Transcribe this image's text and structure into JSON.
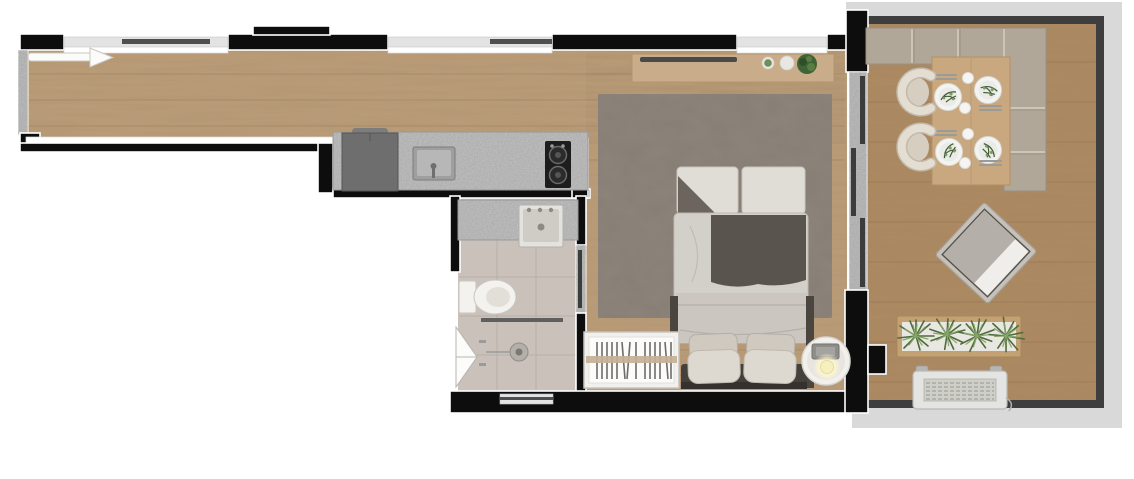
{
  "canvas": {
    "kind": "apartment-floor-plan-top-view",
    "width": 1134,
    "height": 479
  },
  "rooms": [
    {
      "name": "entry-kitchen-hall"
    },
    {
      "name": "bathroom"
    },
    {
      "name": "bedroom"
    },
    {
      "name": "balcony"
    }
  ],
  "furniture": [
    "entry-sliding-door",
    "kitchen-counter",
    "refrigerator",
    "kitchen-sink",
    "cooktop",
    "vanity-counter",
    "vanity-sink",
    "toilet",
    "shower-screen",
    "shower-bifold-door",
    "shower-drain",
    "bathroom-pocket-door",
    "sideboard",
    "decor-dishes",
    "potted-plant",
    "area-rug",
    "double-bed",
    "foot-cushions",
    "throw-blanket",
    "pillows",
    "slatted-bench",
    "bedside-table",
    "table-lamp",
    "balcony-sliding-door",
    "corner-bench-sofa",
    "dining-table",
    "dining-chairs",
    "place-settings",
    "lounge-chair",
    "planter-box",
    "ac-unit"
  ],
  "colors": {
    "wall": "#0d0d0d",
    "wallOutline": "#ffffff",
    "windowLight": "#e3e3e3",
    "windowDark": "#4f4f4f",
    "glassStrip": "#c2c2c2",
    "glassPanel": "#3c3c3c",
    "balconyWall": "#d9d9d9",
    "balconyWallDark": "#3e3e3e",
    "woodMain": "#bb9d79",
    "woodBalcony": "#ad8a62",
    "granite": "#c6c6c6",
    "tile": "#c9c1ba",
    "tileLine": "#b4aba4",
    "rug": "#8d847b",
    "appliance": "#6e6e6e",
    "cooktop": "#1d1d1d",
    "porcelain": "#f4f2ef",
    "sideboard": "#c9ac89",
    "sideboardGroove": "#4a4a4a",
    "duvet": "#d3cfc9",
    "blanket": "#59544e",
    "pillow": "#ddd8d0",
    "bedBase": "#44403c",
    "benchFrame": "#f1f0ee",
    "benchSlat": "#6f6c68",
    "benchRail": "#c3b196",
    "benchCushion": "#b1a798",
    "tableWood": "#c9a87f",
    "garnishDark": "#3f5a34",
    "garnishLight": "#7e9c63",
    "cutlery": "#9a9a96",
    "chair": "#e4ddd1",
    "loungeFrame": "#c6c2bb",
    "loungeCushion": "#b4b0a9",
    "loungeWhite": "#efeeea",
    "planterWood": "#c3a173",
    "planterFill": "#e9e7e2",
    "plantDark": "#4e6b3d",
    "plantLight": "#86a667",
    "acBody": "#e4e4e2",
    "acGrille": "#97978f",
    "lampGlow": "#fff8cf"
  }
}
